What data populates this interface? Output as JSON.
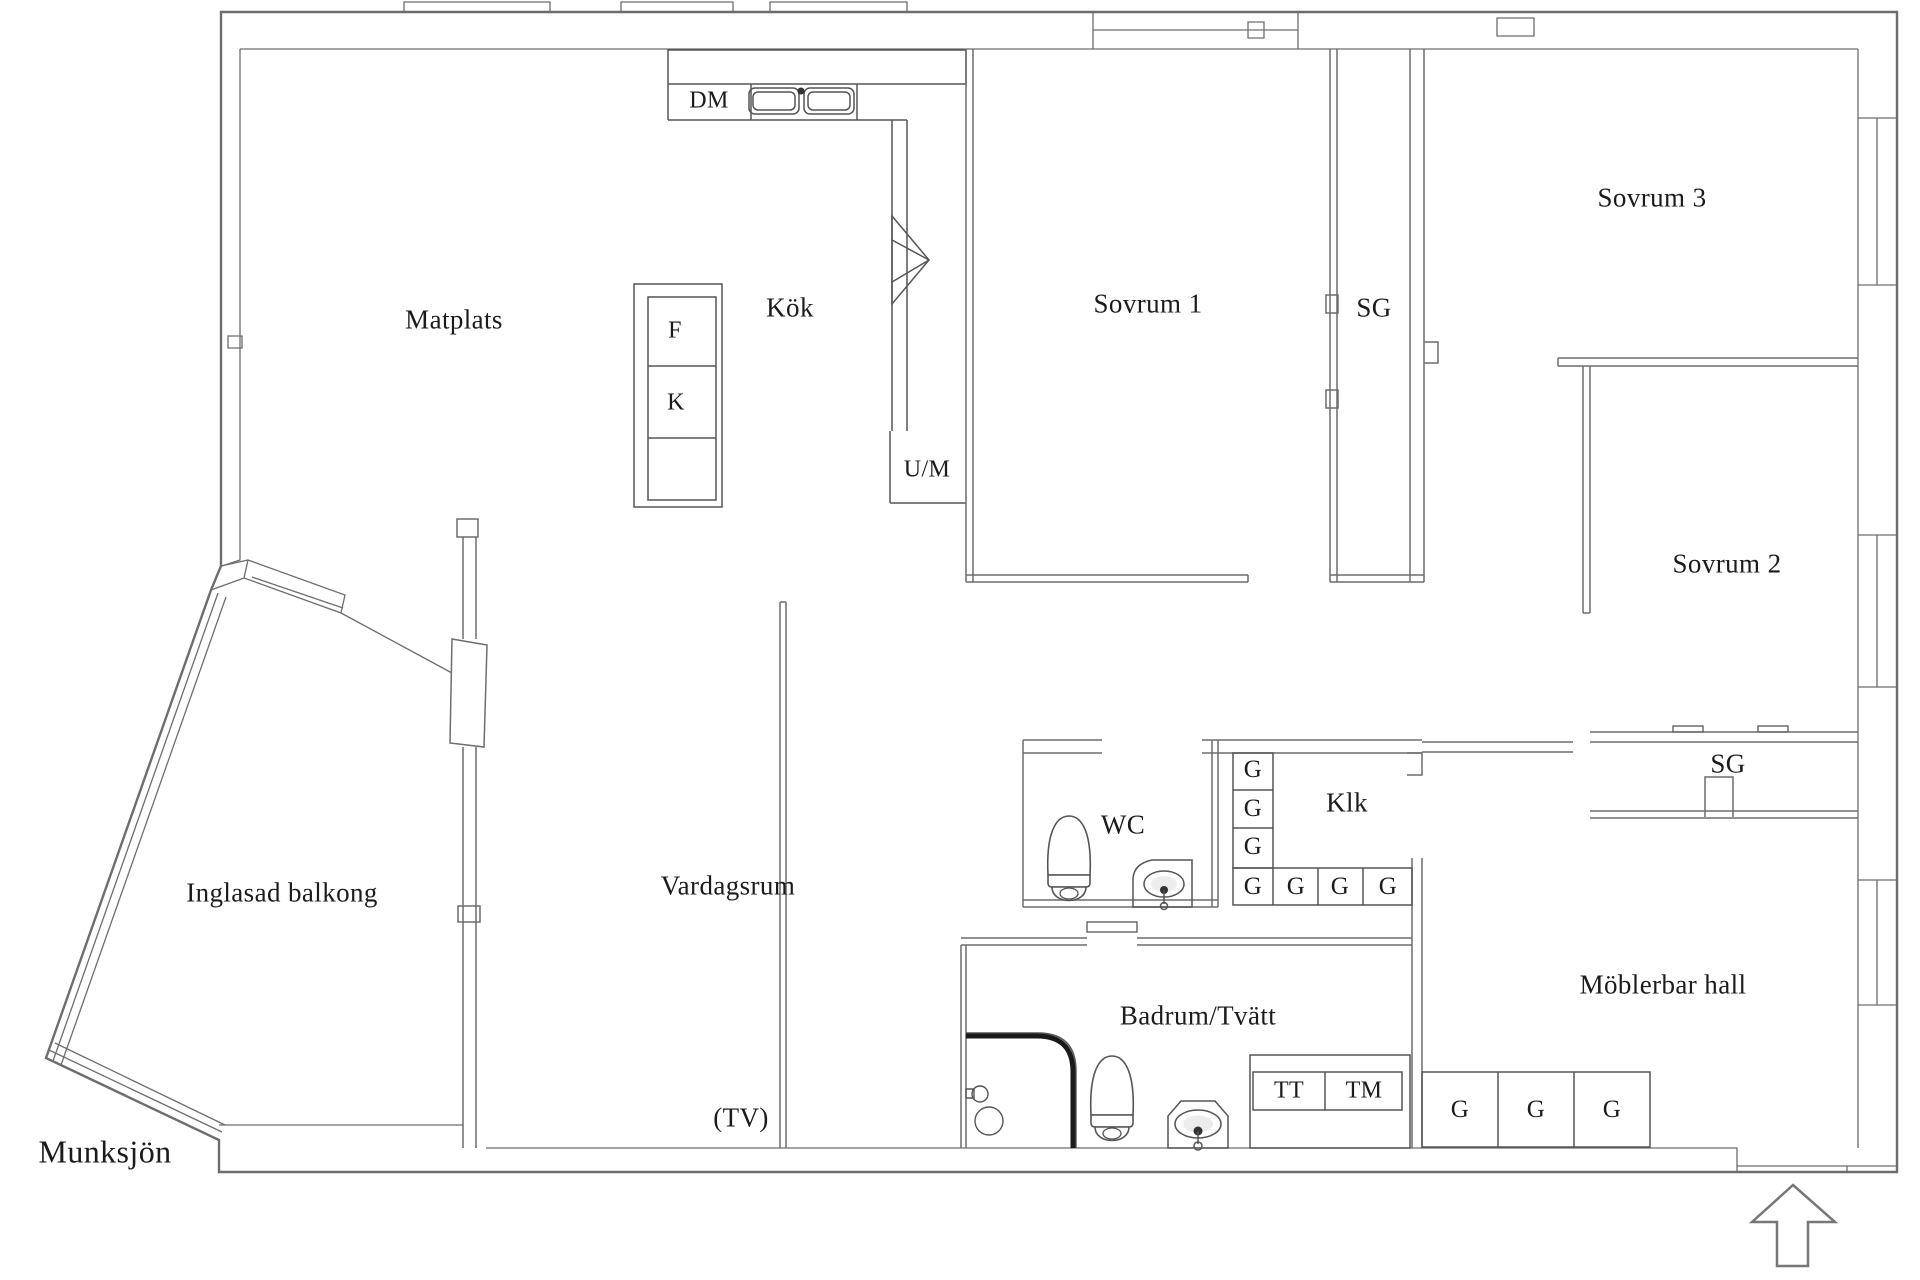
{
  "plan": {
    "environment_label": "Munksjön",
    "rooms": {
      "matplats": "Matplats",
      "kok": "Kök",
      "sovrum1": "Sovrum 1",
      "sovrum2": "Sovrum 2",
      "sovrum3": "Sovrum 3",
      "sg_top": "SG",
      "sg_right": "SG",
      "inglasad_balkong": "Inglasad balkong",
      "vardagsrum": "Vardagsrum",
      "tv_note": "(TV)",
      "wc": "WC",
      "klk": "Klk",
      "badrum_tvatt": "Badrum/Tvätt",
      "hall": "Möblerbar hall"
    },
    "fixtures": {
      "dm": "DM",
      "f": "F",
      "k": "K",
      "um": "U/M",
      "tt": "TT",
      "tm": "TM",
      "g": "G"
    },
    "colors": {
      "wall": "#6d6d6d",
      "fixture": "#555555",
      "shower_edge": "#1a1a1a",
      "text": "#1b1b1b",
      "background": "#ffffff"
    }
  }
}
